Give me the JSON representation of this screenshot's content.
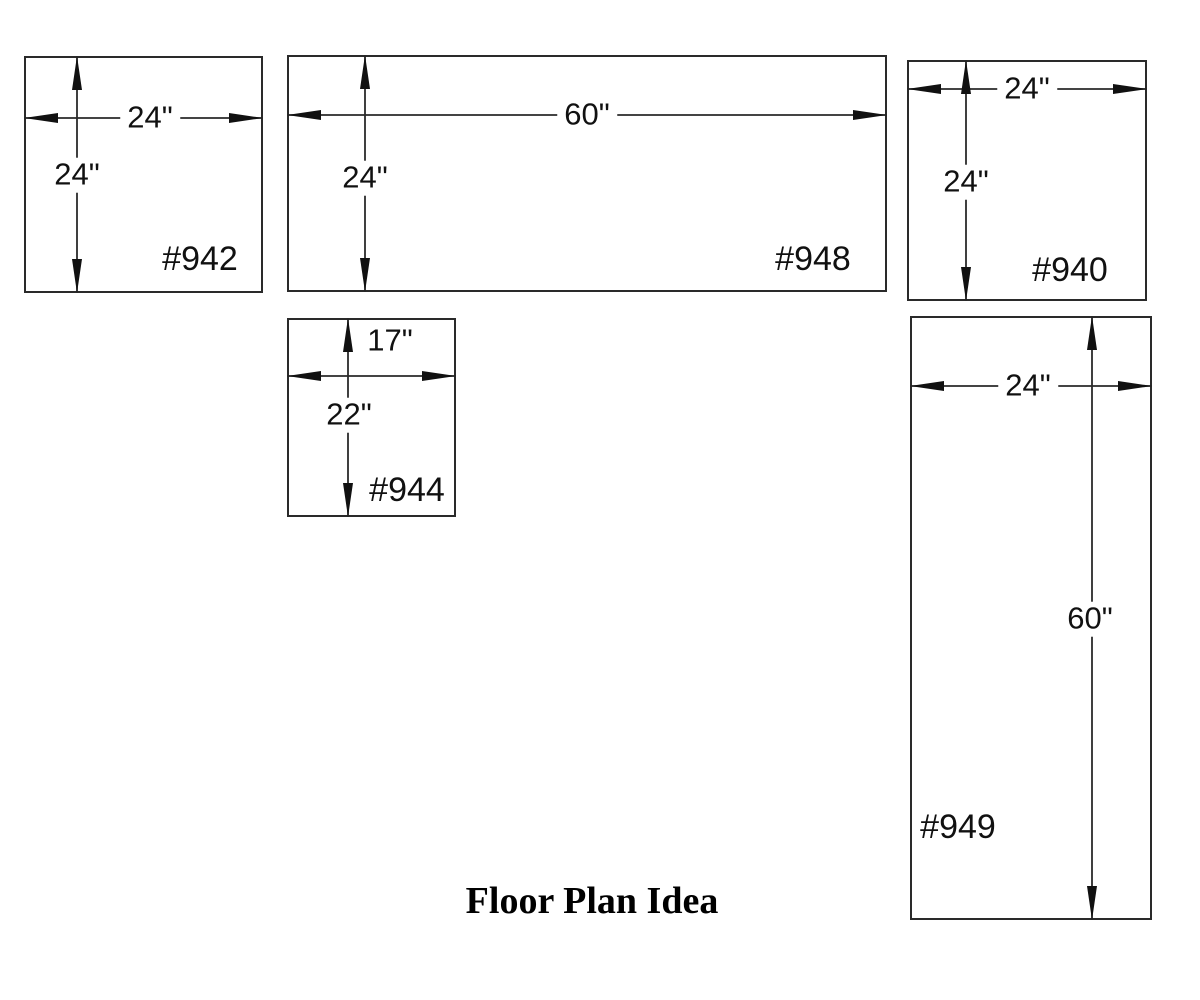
{
  "title": "Floor Plan Idea",
  "colors": {
    "ink": "#1a1a1a",
    "background": "#ffffff"
  },
  "units": [
    {
      "id": "#942",
      "width": "24\"",
      "height": "24\""
    },
    {
      "id": "#948",
      "width": "60\"",
      "height": "24\""
    },
    {
      "id": "#940",
      "width": "24\"",
      "height": "24\""
    },
    {
      "id": "#944",
      "width": "17\"",
      "height": "22\""
    },
    {
      "id": "#949",
      "width": "24\"",
      "height": "60\""
    }
  ]
}
